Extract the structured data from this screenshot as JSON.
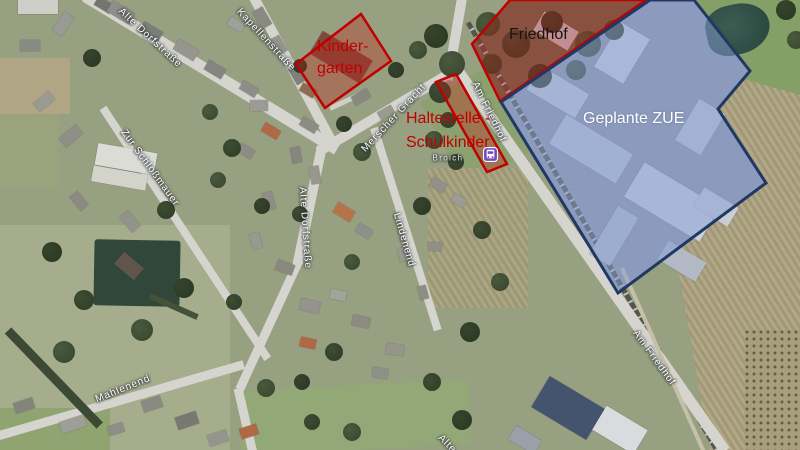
{
  "map": {
    "title": "Aerial map — Jülich-Mersch, planned ZUE site",
    "street_labels": [
      {
        "text": "Alte Dorfstraße",
        "x": 150,
        "y": 38,
        "angle": 43,
        "locality": false
      },
      {
        "text": "Kapellenstraße",
        "x": 266,
        "y": 40,
        "angle": 47,
        "locality": false
      },
      {
        "text": "Zur Schloßmauer",
        "x": 150,
        "y": 168,
        "angle": 54,
        "locality": false
      },
      {
        "text": "Alte Dorfstraße",
        "x": 305,
        "y": 228,
        "angle": 86,
        "locality": false
      },
      {
        "text": "Merscher Gracht",
        "x": 394,
        "y": 118,
        "angle": -47,
        "locality": false
      },
      {
        "text": "Lindenend",
        "x": 404,
        "y": 240,
        "angle": 74,
        "locality": false
      },
      {
        "text": "Mahlenend",
        "x": 123,
        "y": 389,
        "angle": -22,
        "locality": false
      },
      {
        "text": "Am Friedhof",
        "x": 489,
        "y": 112,
        "angle": 64,
        "locality": false
      },
      {
        "text": "Am Friedhof",
        "x": 654,
        "y": 358,
        "angle": 54,
        "locality": false
      },
      {
        "text": "Alte",
        "x": 447,
        "y": 444,
        "angle": 45,
        "locality": false
      },
      {
        "text": "Broich",
        "x": 448,
        "y": 158,
        "angle": 0,
        "locality": true
      }
    ],
    "annotations": [
      {
        "id": "kindergarten",
        "text": "Kinder-\ngarten",
        "color": "#C00000"
      },
      {
        "id": "friedhof",
        "text": "Friedhof",
        "color": "#141414"
      },
      {
        "id": "haltestelle",
        "text": "Haltestelle -\nSchulkinder",
        "color": "#C00000"
      },
      {
        "id": "zue",
        "text": "Geplante ZUE",
        "color": "#FFFFFF"
      }
    ],
    "overlays": [
      {
        "id": "friedhof-area",
        "type": "red",
        "points": [
          [
            472,
            44
          ],
          [
            510,
            0
          ],
          [
            646,
            0
          ],
          [
            500,
            101
          ]
        ]
      },
      {
        "id": "zue-area",
        "type": "blue",
        "points": [
          [
            650,
            0
          ],
          [
            694,
            0
          ],
          [
            750,
            71
          ],
          [
            718,
            109
          ],
          [
            766,
            183
          ],
          [
            618,
            293
          ],
          [
            501,
            102
          ]
        ]
      },
      {
        "id": "kindergarten-area",
        "type": "red",
        "points": [
          [
            296,
            64
          ],
          [
            361,
            14
          ],
          [
            391,
            61
          ],
          [
            325,
            108
          ]
        ]
      },
      {
        "id": "haltestelle-area",
        "type": "red",
        "points": [
          [
            436,
            82
          ],
          [
            456,
            74
          ],
          [
            507,
            164
          ],
          [
            487,
            172
          ]
        ]
      }
    ],
    "colors": {
      "red_stroke": "#C00000",
      "red_fill": "rgba(192,32,24,0.34)",
      "blue_stroke": "#1F3864",
      "blue_fill": "rgba(132,156,212,0.5)",
      "bus_icon": "#7448BE"
    },
    "icons": [
      {
        "name": "bus-stop-icon",
        "x": 484,
        "y": 148
      }
    ]
  }
}
